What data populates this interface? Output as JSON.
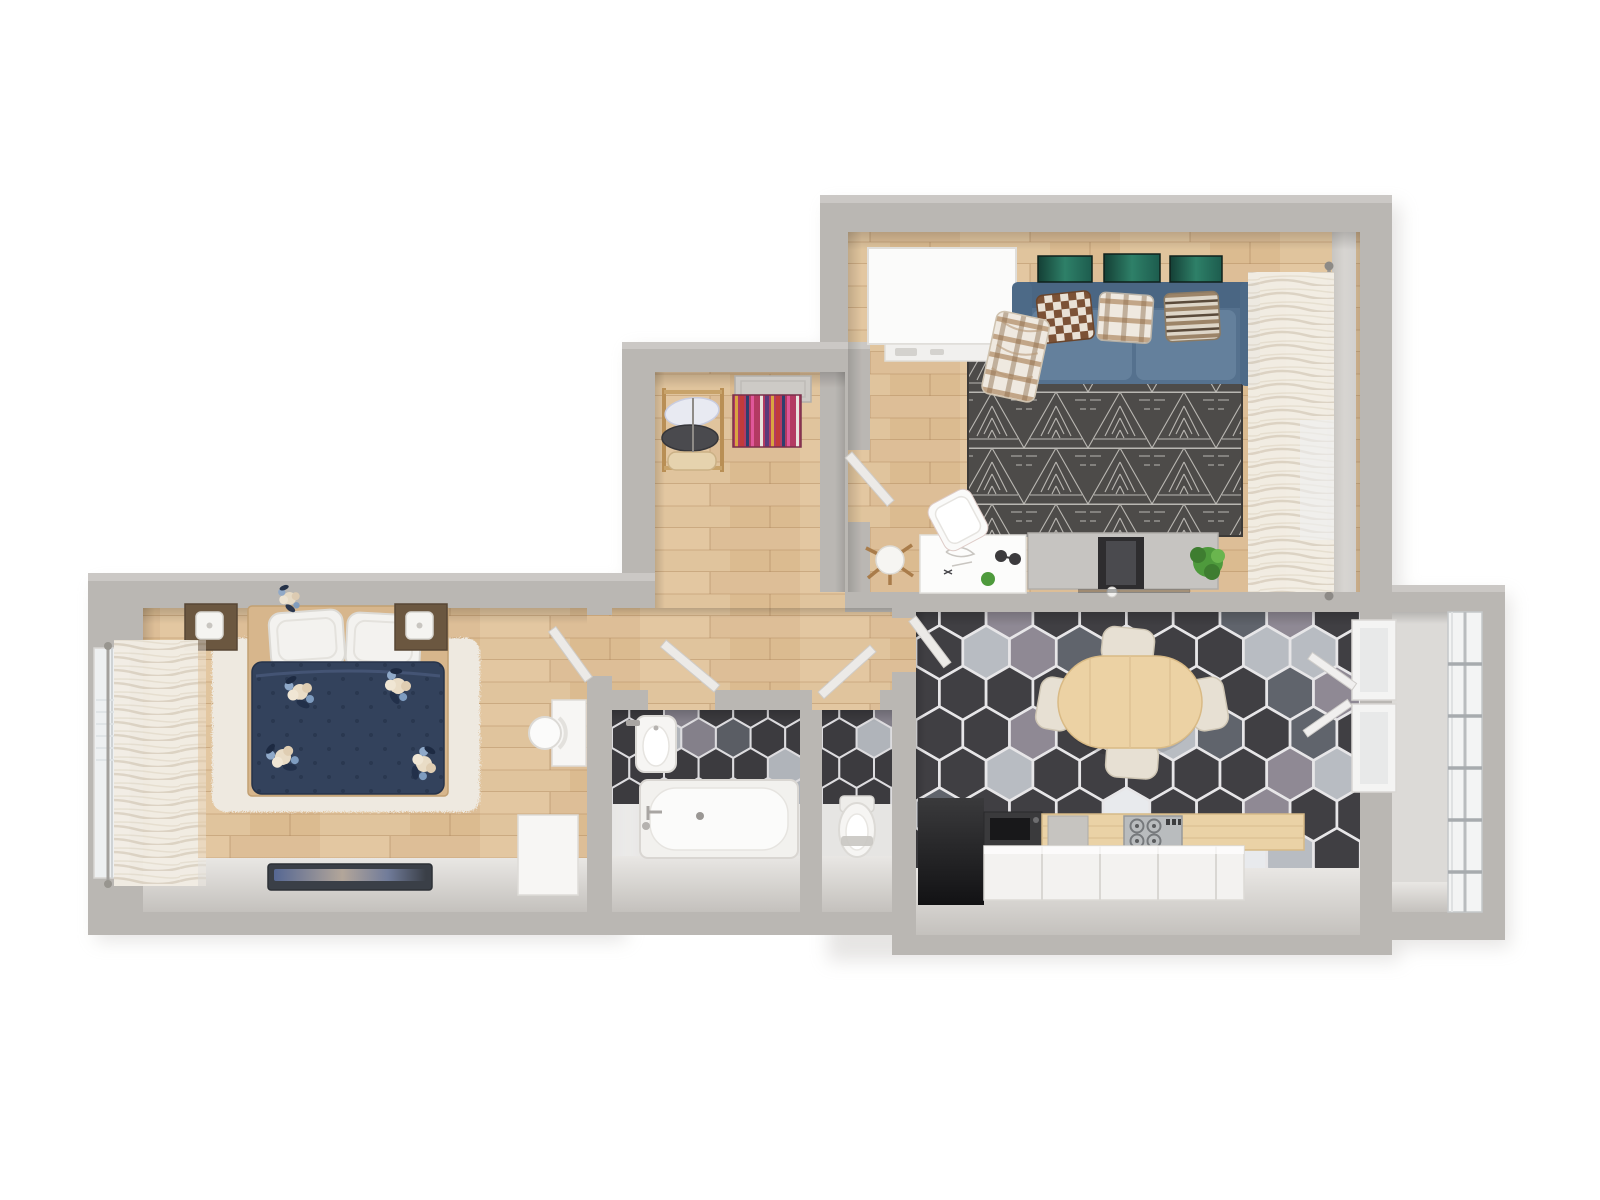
{
  "palette": {
    "background": "#ffffff",
    "wall": "#bab7b3",
    "wallTopEdge": "#cdcac6",
    "wallInnerFace": "#e2e0dd",
    "woodBase": "#e0c49d",
    "rugBedroom": "#eee9e0",
    "rugLivingBase": "#4d4b49",
    "sofa": "#55718e",
    "sofaSeat": "#64809c",
    "sofaArm": "#4d6a87",
    "duvet": "#33425c",
    "pillowWhite": "#f3f2ef",
    "nightstand": "#6b5740",
    "artGreen": "#20604f",
    "tableWood": "#ecd2a4",
    "chairCream": "#e7e0d3",
    "counterWhite": "#f3f2f0",
    "counterWood": "#ead2a6",
    "counterDark": "#3a3a3c",
    "fixtureWhite": "#f6f5f3",
    "door": "#eceae7",
    "curtain": "#f2ede4",
    "glass": "#f3f4f4",
    "plantGreen": "#4e9a3c",
    "tvDark": "#2e2d2f",
    "lampWood": "#a97c4a",
    "balconyFloor": "#dcdad7"
  },
  "hex_floors": [
    {
      "target": "hex-floor-kitchen",
      "x": 916,
      "y": 612,
      "w": 444,
      "h": 260,
      "r": 27,
      "grout": "#e7e6e8",
      "colors": [
        "#403f43",
        "#60646c",
        "#8f8994",
        "#b8bcc2",
        "#e8eaed"
      ],
      "thresholds": [
        0.56,
        0.72,
        0.82,
        0.92
      ]
    },
    {
      "target": "hex-floor-bathroom",
      "x": 612,
      "y": 708,
      "w": 188,
      "h": 96,
      "r": 20,
      "grout": "#dddcdf",
      "colors": [
        "#3c3b3f",
        "#5a5d64",
        "#84808a",
        "#b0b4ba",
        "#e6e8ea"
      ],
      "thresholds": [
        0.6,
        0.75,
        0.85,
        0.93
      ]
    },
    {
      "target": "hex-floor-wc",
      "x": 822,
      "y": 708,
      "w": 70,
      "h": 96,
      "r": 20,
      "grout": "#dddcdf",
      "colors": [
        "#3c3b3f",
        "#5a5d64",
        "#84808a",
        "#b0b4ba",
        "#e6e8ea"
      ],
      "thresholds": [
        0.58,
        0.74,
        0.84,
        0.93
      ]
    }
  ],
  "scene": {
    "type": "3d-apartment-floor-plan-render",
    "rooms": [
      {
        "name": "Living Room",
        "floor": "wood planks",
        "items": [
          "white wardrobe",
          "blue sofa",
          "checkered cushion",
          "plaid cushion",
          "striped cushion",
          "plaid throw",
          "three green wall artworks",
          "dark triangle-pattern rug",
          "white desk",
          "white chair",
          "tripod floor lamp",
          "tv stand",
          "tv",
          "potted plant",
          "sheer curtain",
          "curtain rod"
        ]
      },
      {
        "name": "Kitchen / Dining",
        "floor": "hexagonal tiles",
        "items": [
          "oval wooden dining table",
          "four cream chairs",
          "dark counter with hob",
          "white base cabinets",
          "wood worktop",
          "gas stove",
          "utility niche",
          "two windows to balcony"
        ]
      },
      {
        "name": "Bedroom",
        "floor": "wood planks",
        "items": [
          "double bed",
          "navy floral duvet",
          "two white pillows",
          "two dark nightstands",
          "two white table lamps",
          "shaggy cream rug",
          "wall tv",
          "white desk",
          "white chair",
          "white dresser",
          "window with sheer curtain"
        ]
      },
      {
        "name": "Hallway",
        "floor": "wood planks",
        "items": [
          "entrance door",
          "wooden coat rack with clothes",
          "multicolor striped rug"
        ]
      },
      {
        "name": "Bathroom",
        "floor": "hexagonal tiles",
        "items": [
          "bathtub",
          "washbasin"
        ]
      },
      {
        "name": "WC",
        "floor": "hexagonal tiles",
        "items": [
          "toilet"
        ]
      },
      {
        "name": "Balcony",
        "floor": "concrete",
        "items": [
          "glazed window wall"
        ]
      }
    ]
  }
}
